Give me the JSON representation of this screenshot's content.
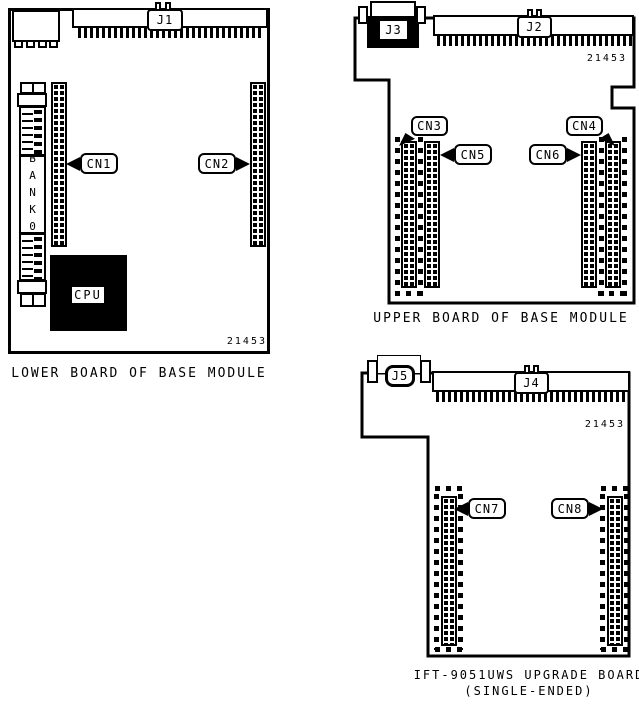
{
  "lower_board": {
    "caption": "LOWER BOARD OF BASE MODULE",
    "part_number": "21453",
    "j1": "J1",
    "cn1": "CN1",
    "cn2": "CN2",
    "bank": "BANK0",
    "cpu": "CPU"
  },
  "upper_board": {
    "caption": "UPPER BOARD OF BASE MODULE",
    "part_number": "21453",
    "j2": "J2",
    "j3": "J3",
    "cn3": "CN3",
    "cn4": "CN4",
    "cn5": "CN5",
    "cn6": "CN6"
  },
  "upgrade_board": {
    "caption_line1": "IFT-9051UWS UPGRADE BOARD",
    "caption_line2": "(SINGLE-ENDED)",
    "part_number": "21453",
    "j4": "J4",
    "j5": "J5",
    "cn7": "CN7",
    "cn8": "CN8"
  }
}
